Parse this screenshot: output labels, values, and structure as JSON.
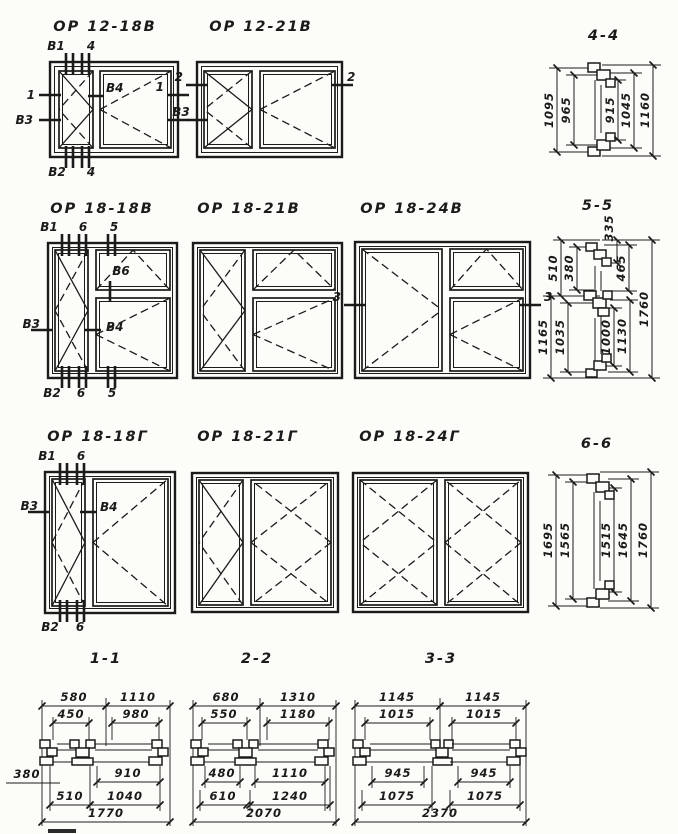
{
  "drawing": {
    "windows": [
      {
        "title": "ОР 12-18В",
        "marks": {
          "top1": "В1",
          "top2": "4",
          "left1": "1",
          "left2": "В3",
          "right1": "1",
          "right2": "В3",
          "bottom1": "В2",
          "bottom2": "4",
          "center": "В4"
        }
      },
      {
        "title": "ОР 12-21В",
        "marks": {
          "left": "2",
          "right": "2"
        }
      },
      {
        "title": "ОР 18-18В",
        "marks": {
          "top1": "В1",
          "top2": "6",
          "top3": "5",
          "left": "В3",
          "center": "В4",
          "transom": "В6",
          "bottom1": "В2",
          "bottom2": "6",
          "bottom3": "5"
        }
      },
      {
        "title": "ОР 18-21В",
        "marks": {}
      },
      {
        "title": "ОР 18-24В",
        "marks": {
          "left": "3",
          "right": "3"
        }
      },
      {
        "title": "ОР 18-18Г",
        "marks": {
          "top1": "В1",
          "top2": "6",
          "left": "В3",
          "center": "В4",
          "bottom1": "В2",
          "bottom2": "6"
        }
      },
      {
        "title": "ОР 18-21Г",
        "marks": {}
      },
      {
        "title": "ОР 18-24Г",
        "marks": {}
      }
    ],
    "sections": [
      {
        "title": "4-4",
        "dims": [
          "1095",
          "965",
          "915",
          "1045",
          "1160"
        ]
      },
      {
        "title": "5-5",
        "dims": [
          "335",
          "510",
          "380",
          "465",
          "1165",
          "1035",
          "1000",
          "1130",
          "1760"
        ]
      },
      {
        "title": "6-6",
        "dims": [
          "1695",
          "1565",
          "1515",
          "1645",
          "1760"
        ]
      },
      {
        "title": "1-1",
        "dims": [
          "580",
          "1110",
          "450",
          "980",
          "380",
          "910",
          "510",
          "1040",
          "1770"
        ]
      },
      {
        "title": "2-2",
        "dims": [
          "680",
          "1310",
          "550",
          "1180",
          "480",
          "1110",
          "610",
          "1240",
          "2070"
        ]
      },
      {
        "title": "3-3",
        "dims": [
          "1145",
          "1145",
          "1015",
          "1015",
          "945",
          "945",
          "1075",
          "1075",
          "2370"
        ]
      }
    ]
  }
}
